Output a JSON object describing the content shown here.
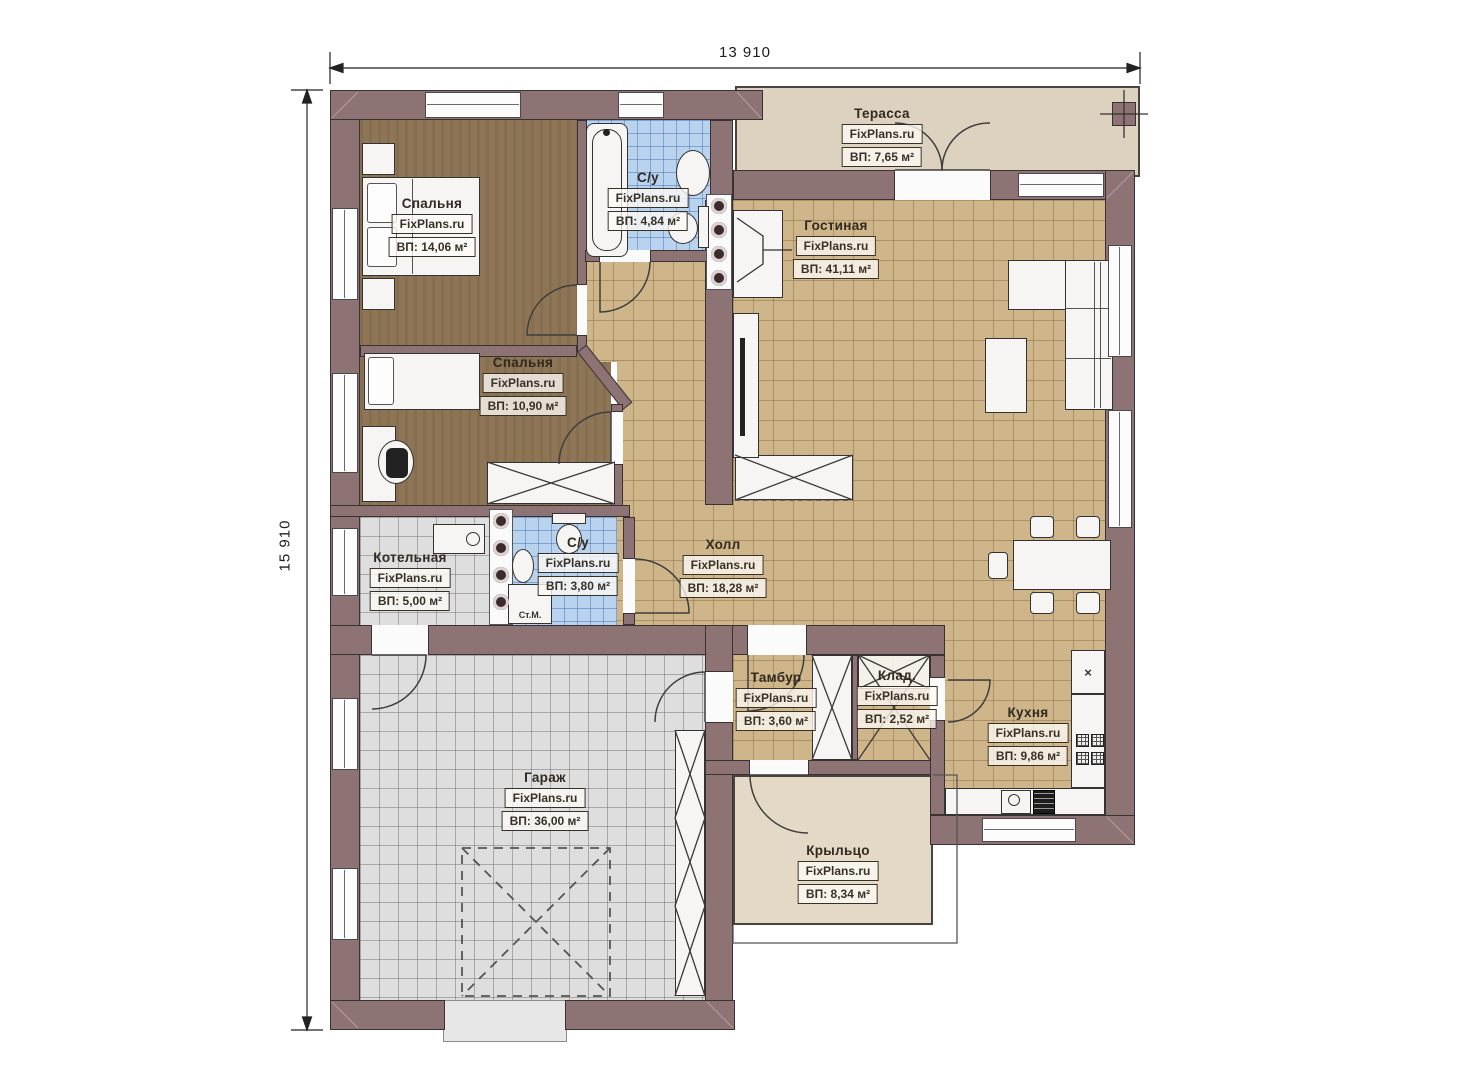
{
  "dimensions": {
    "width": "13 910",
    "height": "15 910"
  },
  "brand": "FixPlans.ru",
  "rooms": [
    {
      "id": "bedroom-1",
      "name": "Спальня",
      "brand": "FixPlans.ru",
      "area": "ВП: 14,06 м²"
    },
    {
      "id": "bathroom-1",
      "name": "С/у",
      "brand": "FixPlans.ru",
      "area": "ВП: 4,84 м²"
    },
    {
      "id": "terrace",
      "name": "Терасса",
      "brand": "FixPlans.ru",
      "area": "ВП: 7,65 м²"
    },
    {
      "id": "living-room",
      "name": "Гостиная",
      "brand": "FixPlans.ru",
      "area": "ВП: 41,11 м²"
    },
    {
      "id": "bedroom-2",
      "name": "Спальня",
      "brand": "FixPlans.ru",
      "area": "ВП: 10,90 м²"
    },
    {
      "id": "boiler-room",
      "name": "Котельная",
      "brand": "FixPlans.ru",
      "area": "ВП: 5,00 м²"
    },
    {
      "id": "bathroom-2",
      "name": "С/у",
      "brand": "FixPlans.ru",
      "area": "ВП: 3,80 м²"
    },
    {
      "id": "hall",
      "name": "Холл",
      "brand": "FixPlans.ru",
      "area": "ВП: 18,28 м²"
    },
    {
      "id": "vestibule",
      "name": "Тамбур",
      "brand": "FixPlans.ru",
      "area": "ВП: 3,60 м²"
    },
    {
      "id": "storage",
      "name": "Клад.",
      "brand": "FixPlans.ru",
      "area": "ВП: 2,52 м²"
    },
    {
      "id": "kitchen",
      "name": "Кухня",
      "brand": "FixPlans.ru",
      "area": "ВП: 9,86 м²"
    },
    {
      "id": "garage",
      "name": "Гараж",
      "brand": "FixPlans.ru",
      "area": "ВП: 36,00 м²"
    },
    {
      "id": "porch",
      "name": "Крыльцо",
      "brand": "FixPlans.ru",
      "area": "ВП: 8,34 м²"
    }
  ],
  "annotations": {
    "washing_machine": "Ст.М.",
    "fridge_mark": "×"
  }
}
